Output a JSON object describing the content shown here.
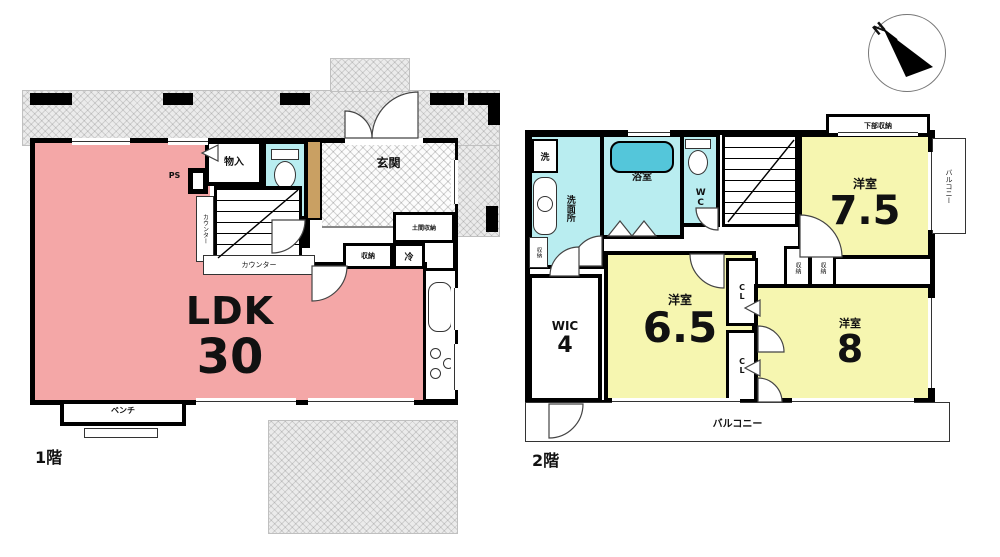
{
  "colors": {
    "ldk_pink": "#f4a7a7",
    "bedroom_yellow": "#f6f6b0",
    "wet_area_blue": "#b9edf0",
    "bathtub_teal": "#54c6da",
    "shoe_cabinet_tan": "#c9a063",
    "wall_black": "#000000",
    "hatch_gray": "#ebebeb"
  },
  "compass": {
    "north_label": "N"
  },
  "floor1": {
    "floor_label": "1階",
    "ldk_name": "LDK",
    "ldk_size": "30",
    "entrance": "玄関",
    "toilet": "WC",
    "storage_top": "物入",
    "pipe_space": "PS",
    "counter_vertical": "カウンター",
    "counter": "カウンター",
    "storage_small": "収納",
    "fridge": "冷",
    "entrance_storage": "土間収納",
    "bench": "ベンチ"
  },
  "floor2": {
    "floor_label": "2階",
    "washroom": "洗面所",
    "washer": "洗",
    "washroom_storage": "収納",
    "bathroom": "浴室",
    "toilet": "WC",
    "bedroom1_name": "洋室",
    "bedroom1_size": "7.5",
    "under_window_storage": "下部収納",
    "balcony_side": "バルコニー",
    "wic_name": "WIC",
    "wic_size": "4",
    "bedroom2_name": "洋室",
    "bedroom2_size": "6.5",
    "closet_top": "CL",
    "closet_bottom": "CL",
    "storage_a": "収納",
    "storage_b": "収納",
    "bedroom3_name": "洋室",
    "bedroom3_size": "8",
    "balcony_bottom": "バルコニー"
  }
}
